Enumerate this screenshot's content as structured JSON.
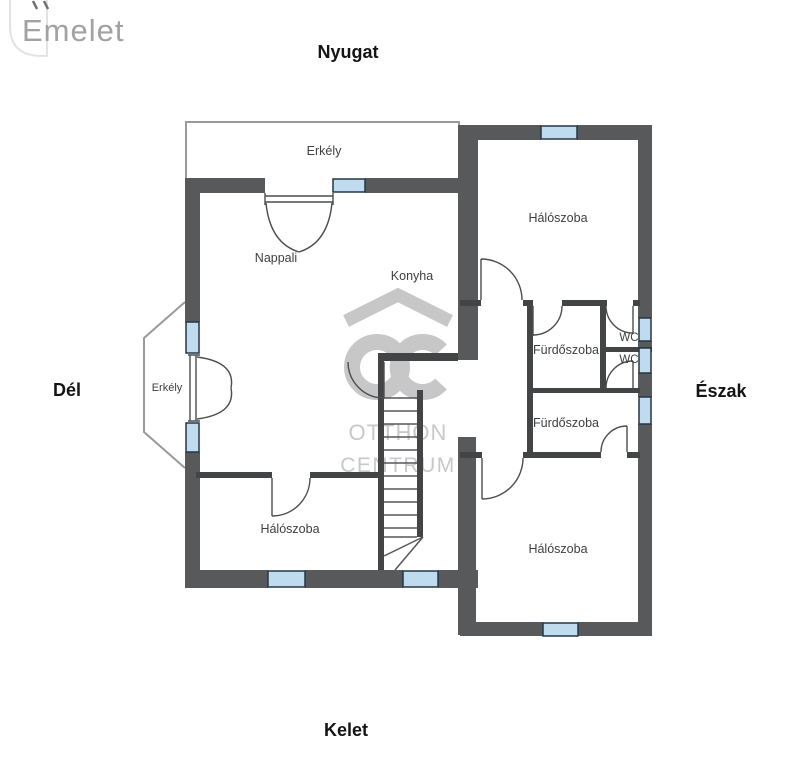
{
  "logo": {
    "text": "Emelet"
  },
  "compass": {
    "west": "Nyugat",
    "south": "Dél",
    "north": "Észak",
    "east": "Kelet"
  },
  "rooms": {
    "balcony_top": "Erkély",
    "balcony_west": "Erkély",
    "living_room": "Nappali",
    "kitchen": "Konyha",
    "bedroom_north": "Hálószoba",
    "bedroom_southeast": "Hálószoba",
    "bedroom_southwest": "Hálószoba",
    "bathroom_upper": "Fürdőszoba",
    "bathroom_lower": "Fürdőszoba",
    "wc_upper": "WC",
    "wc_lower": "WC"
  },
  "watermark": {
    "monogram": "OC",
    "line1": "OTTHON",
    "line2": "CENTRUM"
  },
  "colors": {
    "wall": "#58595b",
    "partition": "#434446",
    "window_fill": "#bfdcee",
    "window_border": "#263546",
    "door_line": "#4c4d4f",
    "stair_line": "#55565a",
    "balcony_outline": "#9a9a9a",
    "watermark": "#c7c7c7",
    "label": "#3e3f41",
    "compass": "#141414",
    "logo": "#a2a2a2"
  }
}
